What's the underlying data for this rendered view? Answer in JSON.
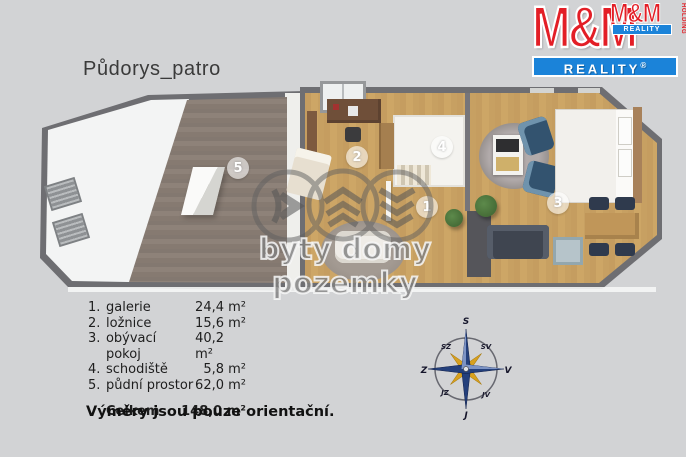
{
  "title": "Půdorys_patro",
  "logo": {
    "mm": "M&M",
    "reality": "REALITY",
    "reg": "®",
    "holding": "HOLDING",
    "red": "#e31e26",
    "blue": "#1b83d9"
  },
  "plan": {
    "badges": {
      "b1": "1",
      "b2": "2",
      "b3": "3",
      "b4": "4",
      "b5": "5"
    }
  },
  "watermark": {
    "text": "byty domy pozemky"
  },
  "legend": {
    "items": [
      {
        "num": "1.",
        "name": "galerie",
        "area": "24,4 m²"
      },
      {
        "num": "2.",
        "name": "ložnice",
        "area": "15,6 m²"
      },
      {
        "num": "3.",
        "name": "obývací pokoj",
        "area": "40,2 m²"
      },
      {
        "num": "4.",
        "name": "schodiště",
        "area": "5,8 m²"
      },
      {
        "num": "5.",
        "name": "půdní prostor",
        "area": "62,0 m²"
      }
    ],
    "total_label": "Celkem",
    "total_area": "148,0 m²",
    "note": "Výměry jsou pouze orientační."
  },
  "compass": {
    "top": "S",
    "top_right": "SV",
    "right": "V",
    "bottom_right": "JV",
    "bottom": "J",
    "bottom_left": "JZ",
    "left": "Z",
    "top_left": "SZ"
  },
  "colors": {
    "background": "#d2d3d5",
    "wall": "#6e6e72",
    "floor_main": "#c8a263",
    "floor_attic": "#897d74",
    "compass_blue": "#24407c",
    "compass_gold": "#d8a11f"
  }
}
